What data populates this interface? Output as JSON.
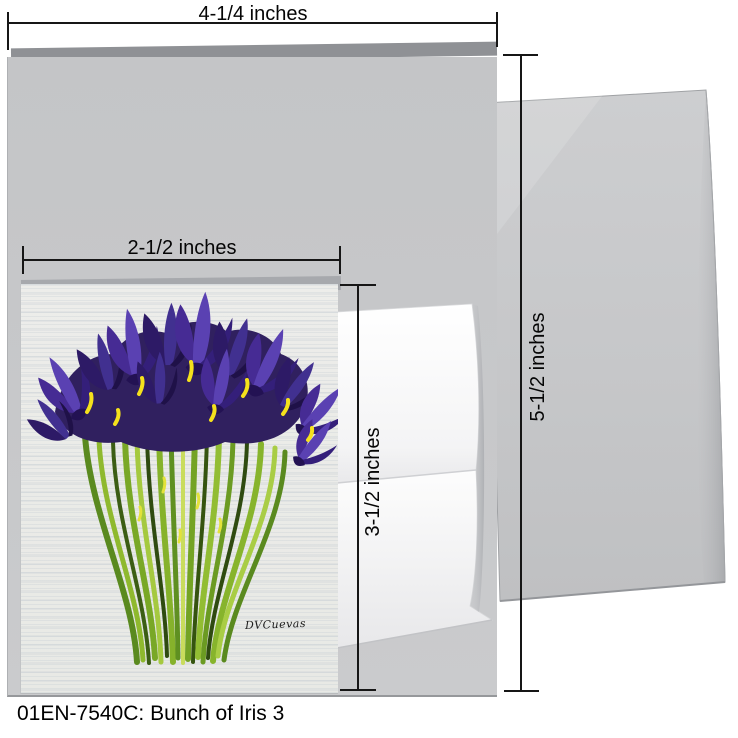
{
  "caption": "01EN-7540C: Bunch of Iris 3",
  "dimensions": {
    "large_card_width": "4-1/4 inches",
    "large_card_height": "5-1/2 inches",
    "small_card_width": "2-1/2 inches",
    "small_card_height": "3-1/2 inches"
  },
  "artwork": {
    "signature": "DVCuevas"
  },
  "colors": {
    "card_gray": "#c6c7c9",
    "card_back_gray": "#8f9195",
    "envelope_white": "#fafafa",
    "canvas_offwhite": "#eaebe7",
    "iris_purple": "#462b94",
    "iris_dark_purple": "#231253",
    "iris_yellow": "#f5e11c",
    "stem_green": "#79a826",
    "dimension_line": "#161616"
  }
}
